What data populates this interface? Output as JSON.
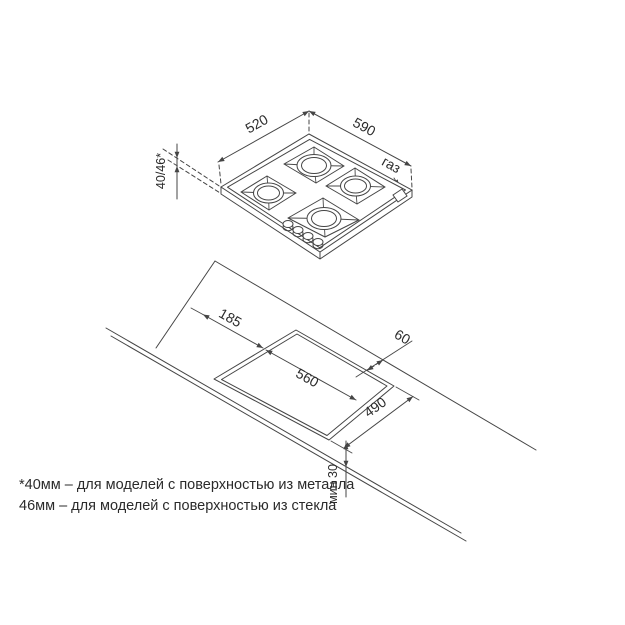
{
  "drawing": {
    "hob": {
      "width_label": "520",
      "depth_label": "590",
      "gas_label": "газ",
      "thickness_label": "40/46*"
    },
    "cutout": {
      "left_offset_label": "185",
      "width_label": "560",
      "back_gap_label": "60",
      "depth_label": "490",
      "front_min_label": "мин 30"
    },
    "footnotes": {
      "line1": "*40мм – для моделей с поверхностью из металла",
      "line2": "46мм – для моделей с поверхностью из стекла"
    },
    "colors": {
      "line": "#454545",
      "text": "#2b2b2b",
      "background": "#ffffff"
    }
  }
}
